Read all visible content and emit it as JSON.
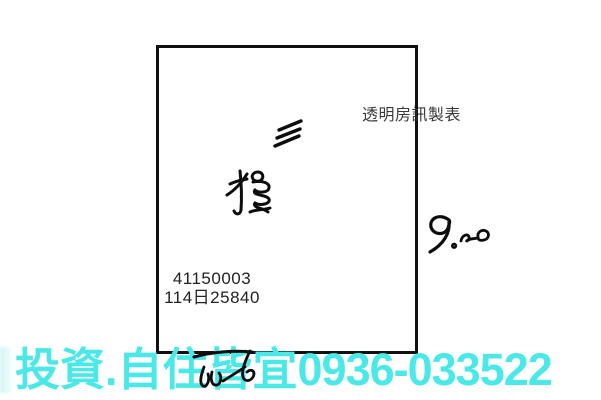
{
  "page": {
    "background": "#ffffff"
  },
  "diagram": {
    "border_color": "#101010",
    "credit_label": "透明房訊製表",
    "parcel_numbers": {
      "line1": "41150003",
      "line2": "114日25840"
    },
    "annotations": {
      "count_mark": "三",
      "type_mark": "種",
      "measurement": "9.20"
    }
  },
  "banner": {
    "slogan": "投資.自住皆宜",
    "phone": "0936-033522",
    "color": "#4BE8E8"
  }
}
